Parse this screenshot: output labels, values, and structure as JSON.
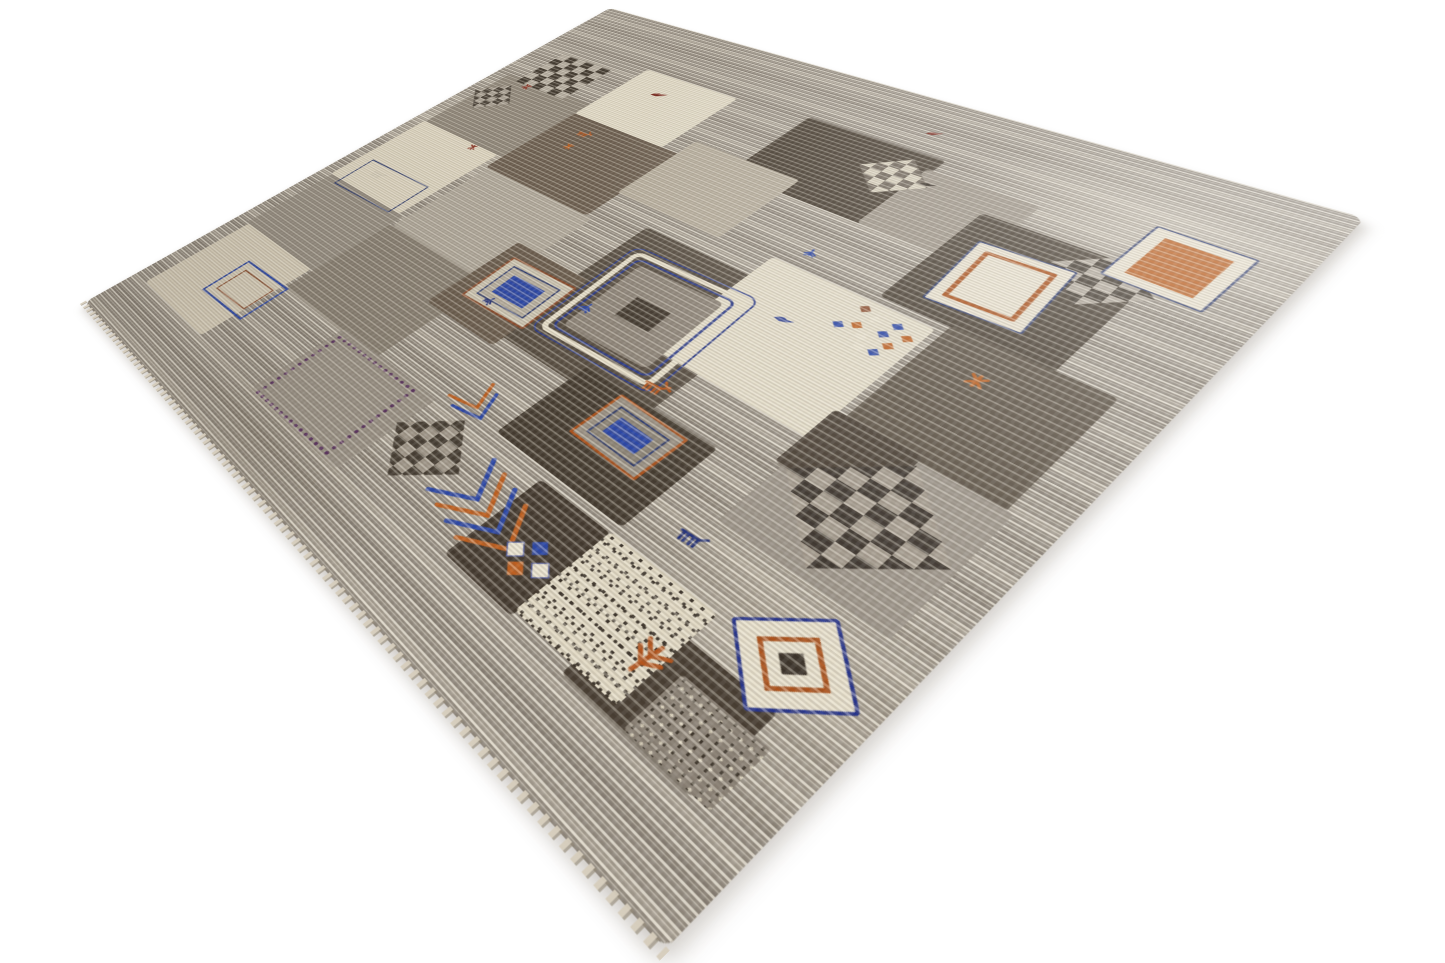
{
  "scene": {
    "label": "Hand-knotted grey patchwork Gabbeh wool rug with checkerboard, framed-rectangle and animal motifs, photographed at an angle on a white background"
  },
  "palette": {
    "background": "#ffffff",
    "field_gray": "#a49d93",
    "cream": "#e6dfcb",
    "taupe": "#8f8679",
    "brown": "#6b5d4e",
    "dark_brown": "#453b2f",
    "rust_orange": "#bd5f1f",
    "royal_blue": "#2b47a8",
    "navy": "#2c3a6e",
    "maroon": "#7c2a20"
  },
  "glyphs": {
    "bird": {
      "vb": "0 0 20 14",
      "d": "M1 11 Q6 3 12 6 L19 4 L14 9 L8 12 Z",
      "fill": true
    },
    "animal": {
      "vb": "0 0 22 16",
      "d": "M3 6 H16 M16 6 L20 3 M5 6 V13 M8 6 V13 M12 6 V13 M15 6 V13"
    },
    "deer": {
      "vb": "0 0 24 18",
      "d": "M4 8 H17 M17 8 L21 4 M19 5 L23 7 M18 4 L16 1 M6 8 V15 M9 8 V15 M13 8 V15 M16 8 V15"
    },
    "plant": {
      "vb": "0 0 20 20",
      "d": "M10 2 V18 M10 8 L4 3 M10 8 L16 3 M10 13 L4 8 M10 13 L16 8"
    },
    "mark": {
      "vb": "0 0 12 12",
      "d": "M2 2 L10 10 M10 2 L2 10 M6 1 V11"
    },
    "sprig": {
      "vb": "0 0 16 16",
      "d": "M8 3 V13 M8 7 L3 11 M8 7 L13 11 M8 10 L4 14 M8 10 L12 14"
    }
  },
  "elements": [
    {
      "t": "patch",
      "n": "patch-taupe-left",
      "x": 25,
      "y": 252,
      "w": 178,
      "h": 172,
      "c": "#8f8679"
    },
    {
      "t": "patch",
      "n": "patch-cream-left",
      "x": 22,
      "y": 424,
      "w": 168,
      "h": 178,
      "c": "#e2dac5"
    },
    {
      "t": "patch",
      "n": "patch-gray-left",
      "x": 25,
      "y": 602,
      "w": 175,
      "h": 150,
      "c": "#978f83"
    },
    {
      "t": "patch",
      "n": "patch-cream-left-low",
      "x": 30,
      "y": 752,
      "w": 165,
      "h": 168,
      "c": "#dcd3be"
    },
    {
      "t": "patch",
      "n": "patch-cream-top",
      "x": 200,
      "y": 130,
      "w": 162,
      "h": 152,
      "c": "#e5deca"
    },
    {
      "t": "patch",
      "n": "patch-brown-mid",
      "x": 200,
      "y": 282,
      "w": 192,
      "h": 172,
      "c": "#6b5d4e"
    },
    {
      "t": "patch",
      "n": "patch-lightgray-mid",
      "x": 205,
      "y": 454,
      "w": 198,
      "h": 170,
      "c": "#b2aa9d"
    },
    {
      "t": "patch",
      "n": "patch-taupe-mid",
      "x": 200,
      "y": 624,
      "w": 198,
      "h": 170,
      "c": "#898073"
    },
    {
      "t": "patch",
      "n": "patch-gray-bottom",
      "x": 328,
      "y": 790,
      "w": 175,
      "h": 132,
      "c": "#9a9286"
    },
    {
      "t": "patch",
      "n": "patch-darkbrown-top",
      "x": 468,
      "y": 120,
      "w": 184,
      "h": 160,
      "c": "#453b2f"
    },
    {
      "t": "patch",
      "n": "patch-warmgray-top",
      "x": 388,
      "y": 246,
      "w": 158,
      "h": 148,
      "c": "#b7ae9d"
    },
    {
      "t": "patch",
      "n": "patch-medallion-host",
      "x": 468,
      "y": 428,
      "w": 208,
      "h": 248,
      "c": "#564c40"
    },
    {
      "t": "patch",
      "n": "patch-brown-g",
      "x": 366,
      "y": 545,
      "w": 118,
      "h": 148,
      "c": "#6a5c4d"
    },
    {
      "t": "patch",
      "n": "patch-dark-o",
      "x": 585,
      "y": 648,
      "w": 168,
      "h": 128,
      "c": "#433a2f"
    },
    {
      "t": "patch",
      "n": "patch-cream-center",
      "x": 614,
      "y": 386,
      "w": 188,
      "h": 198,
      "c": "#e6dfcb"
    },
    {
      "t": "patch",
      "n": "patch-gray-top-mid",
      "x": 645,
      "y": 146,
      "w": 128,
      "h": 134,
      "c": "#9d9487"
    },
    {
      "t": "patch",
      "n": "patch-dark-right",
      "x": 735,
      "y": 190,
      "w": 172,
      "h": 184,
      "c": "#483e32"
    },
    {
      "t": "patch",
      "n": "patch-brown-right",
      "x": 810,
      "y": 372,
      "w": 150,
      "h": 176,
      "c": "#5a5043"
    },
    {
      "t": "patch",
      "n": "patch-gray-right-low",
      "x": 806,
      "y": 545,
      "w": 160,
      "h": 168,
      "c": "#9c9489"
    },
    {
      "t": "patch",
      "n": "patch-dark-corner",
      "x": 798,
      "y": 538,
      "w": 86,
      "h": 88,
      "c": "#473d32"
    },
    {
      "t": "patch",
      "n": "patch-dark-dots",
      "x": 662,
      "y": 788,
      "w": 90,
      "h": 120,
      "c": "#42382e"
    },
    {
      "t": "patch",
      "n": "patch-dark-bottom-right",
      "x": 818,
      "y": 820,
      "w": 130,
      "h": 94,
      "c": "#473d32"
    },
    {
      "t": "checker",
      "n": "checker-top-left",
      "x": 52,
      "y": 160,
      "w": 102,
      "h": 102,
      "cell": 17,
      "c1": "#40382e",
      "c2": "#b7afa2"
    },
    {
      "t": "checker",
      "n": "checker-top-left-2",
      "x": 16,
      "y": 276,
      "w": 80,
      "h": 80,
      "cell": 13,
      "c1": "#4a4238",
      "c2": "#aaa295",
      "clip": 1
    },
    {
      "t": "checker",
      "n": "checker-top-mid",
      "x": 580,
      "y": 136,
      "w": 86,
      "h": 86,
      "cell": 14,
      "c1": "#6e6458",
      "c2": "#d9d1bd",
      "clip": 1
    },
    {
      "t": "checker",
      "n": "checker-right",
      "x": 826,
      "y": 180,
      "w": 96,
      "h": 96,
      "cell": 16,
      "c1": "#40382e",
      "c2": "#b3ab9e",
      "clip": 1
    },
    {
      "t": "checker",
      "n": "checker-large-bottom",
      "x": 810,
      "y": 550,
      "w": 152,
      "h": 152,
      "cell": 19,
      "c1": "#39312a",
      "c2": "#a59c8f",
      "clip": 1
    },
    {
      "t": "checker",
      "n": "checker-bottom-left",
      "x": 498,
      "y": 788,
      "w": 102,
      "h": 102,
      "cell": 15,
      "c1": "#453d33",
      "c2": "#a39a8d",
      "clip": 1
    },
    {
      "t": "frame",
      "n": "medallion",
      "x": 488,
      "y": 458,
      "w": 168,
      "h": 184,
      "rot": -3,
      "layers": [
        {
          "bc": "#2a3a8a",
          "bw": 2,
          "r": 14
        },
        {
          "i": 7,
          "bc": "#e9e1cc",
          "bw": 7,
          "r": 12
        },
        {
          "i": 17,
          "bc": "#2a3a8a",
          "bw": 3,
          "r": 10
        },
        {
          "i": 27,
          "bg": "#8d8478",
          "r": 7
        },
        {
          "w": 46,
          "h": 38,
          "bg": "#3f362c"
        }
      ]
    },
    {
      "t": "frame",
      "n": "framed-rect-cream",
      "x": 762,
      "y": 232,
      "w": 96,
      "h": 116,
      "rot": -4,
      "layers": [
        {
          "bg": "#ebe4d1",
          "bc": "#2c3a6e",
          "bw": 2,
          "r": 3
        },
        {
          "i": 13,
          "bc": "#ad531d",
          "bw": 5,
          "bg": "#ebe4d1",
          "r": 2
        }
      ]
    },
    {
      "t": "frame",
      "n": "framed-rect-orange",
      "x": 870,
      "y": 116,
      "w": 90,
      "h": 104,
      "rot": 2,
      "layers": [
        {
          "bg": "#ebe4d1",
          "bc": "#2c3a6e",
          "bw": 2,
          "r": 3
        },
        {
          "i": 15,
          "bg": "#bd5f1f"
        }
      ]
    },
    {
      "t": "frame",
      "n": "framed-rect-blue",
      "x": 386,
      "y": 566,
      "w": 102,
      "h": 90,
      "rot": -3,
      "layers": [
        {
          "bg": "#cfc7b4",
          "bc": "#8a4a2a",
          "bw": 3,
          "r": 3
        },
        {
          "i": 13,
          "bc": "#2c3a6e",
          "bw": 2,
          "bg": "#b9b1a2"
        },
        {
          "i": 26,
          "bg": "#2b47a8"
        }
      ]
    },
    {
      "t": "frame",
      "n": "framed-rect-small",
      "x": 638,
      "y": 656,
      "w": 88,
      "h": 72,
      "rot": 2,
      "layers": [
        {
          "bc": "#ad531d",
          "bw": 3,
          "bg": "#9c9386",
          "r": 2
        },
        {
          "i": 12,
          "bc": "#2c3a6e",
          "bw": 2,
          "bg": "#8e8679"
        },
        {
          "i": 23,
          "bg": "#2b47a8"
        }
      ]
    },
    {
      "t": "frame",
      "n": "outlined-rect",
      "x": 46,
      "y": 538,
      "w": 128,
      "h": 74,
      "rot": -2,
      "layers": [
        {
          "bc": "#2c3a6e",
          "bw": 2
        }
      ]
    },
    {
      "t": "frame",
      "n": "amulet-diamond",
      "x": 891,
      "y": 740,
      "w": 80,
      "h": 80,
      "rot": 45,
      "layers": [
        {
          "bg": "#e9e2cf",
          "bc": "#26348c",
          "bw": 3,
          "r": 4
        },
        {
          "i": 17,
          "bc": "#ad531d",
          "bw": 4,
          "bg": "#e9e2cf"
        },
        {
          "i": 31,
          "bg": "#3b332a"
        }
      ]
    },
    {
      "t": "frame",
      "n": "comb-motif",
      "x": 110,
      "y": 796,
      "w": 98,
      "h": 76,
      "rot": -2,
      "layers": [
        {
          "bc": "#2b47a8",
          "bw": 3
        },
        {
          "i": 14,
          "bc": "#8a4a2a",
          "bw": 2
        }
      ]
    },
    {
      "t": "dborder",
      "n": "diamond-border-square",
      "x": 336,
      "y": 798,
      "w": 132,
      "h": 114,
      "c": "#5b3460",
      "bw": 5,
      "rot": -2
    },
    {
      "t": "zigzag",
      "n": "chevron-arrows",
      "x": 588,
      "y": 812,
      "w": 150,
      "h": 110,
      "rot": 15,
      "sw": 5,
      "strokes": [
        {
          "c": "#2b47a8",
          "pts": "8,6 44,42 8,78"
        },
        {
          "c": "#c06020",
          "pts": "30,6 66,42 30,78"
        },
        {
          "c": "#2b47a8",
          "pts": "52,6 88,42 52,78"
        },
        {
          "c": "#c06020",
          "pts": "74,6 110,42 74,78"
        }
      ]
    },
    {
      "t": "zigzag",
      "n": "chevron-small",
      "x": 508,
      "y": 742,
      "w": 80,
      "h": 64,
      "rot": 28,
      "sw": 4,
      "strokes": [
        {
          "c": "#c06020",
          "pts": "6,4 34,28 6,52"
        },
        {
          "c": "#2b47a8",
          "pts": "22,4 50,28 22,52"
        }
      ]
    },
    {
      "t": "dots4",
      "n": "four-dot-motif",
      "x": 696,
      "y": 836,
      "s": 14,
      "items": [
        {
          "dx": 0,
          "dy": 15,
          "c": "#ece5d2",
          "o": 1
        },
        {
          "dx": 16,
          "dy": 0,
          "c": "#2b47a8"
        },
        {
          "dx": 16,
          "dy": 30,
          "c": "#c06020"
        },
        {
          "dx": 32,
          "dy": 15,
          "c": "#ece5d2",
          "o": 1
        }
      ]
    },
    {
      "t": "confetti",
      "n": "confetti-cluster",
      "x": 726,
      "y": 390,
      "s": 9,
      "items": [
        [
          0,
          42,
          "#2b47a8"
        ],
        [
          14,
          32,
          "#c06020"
        ],
        [
          27,
          44,
          "#ece5d2"
        ],
        [
          40,
          28,
          "#2b47a8"
        ],
        [
          53,
          40,
          "#c06020"
        ],
        [
          22,
          14,
          "#ece5d2"
        ],
        [
          44,
          10,
          "#2b47a8"
        ],
        [
          60,
          20,
          "#c06020"
        ],
        [
          6,
          6,
          "#8a4a2a"
        ],
        [
          34,
          58,
          "#ece5d2"
        ],
        [
          48,
          56,
          "#2b47a8"
        ]
      ]
    },
    {
      "t": "speckle",
      "n": "speckled-patch",
      "x": 750,
      "y": 786,
      "w": 116,
      "h": 116,
      "bg": "#e3dbc6",
      "dot": "#3b332a"
    },
    {
      "t": "noise",
      "n": "salt-pepper-patch",
      "x": 882,
      "y": 846,
      "w": 80,
      "h": 66
    },
    {
      "t": "glyph",
      "g": "bird",
      "n": "bird-red",
      "x": 252,
      "y": 168,
      "s": 26,
      "c": "#7c2a20",
      "rot": -8
    },
    {
      "t": "glyph",
      "g": "mark",
      "n": "mark-red",
      "x": 72,
      "y": 258,
      "s": 15,
      "c": "#8a3324",
      "rot": 10
    },
    {
      "t": "glyph",
      "g": "sprig",
      "n": "sprig-blue",
      "x": 508,
      "y": 570,
      "s": 20,
      "c": "#2b47a8",
      "rot": 0
    },
    {
      "t": "glyph",
      "g": "sprig",
      "n": "sprig-blue-2",
      "x": 632,
      "y": 346,
      "s": 18,
      "c": "#2b47a8",
      "rot": -10
    },
    {
      "t": "glyph",
      "g": "mark",
      "n": "mark-orange",
      "x": 856,
      "y": 416,
      "s": 20,
      "c": "#bd5f1f",
      "rot": 0
    },
    {
      "t": "glyph",
      "g": "deer",
      "n": "deer-orange",
      "x": 640,
      "y": 612,
      "s": 34,
      "c": "#b5551d",
      "rot": -6
    },
    {
      "t": "glyph",
      "g": "deer",
      "n": "deer-orange-2",
      "x": 238,
      "y": 306,
      "s": 26,
      "c": "#b5551d",
      "rot": 0
    },
    {
      "t": "glyph",
      "g": "animal",
      "n": "horse-navy",
      "x": 788,
      "y": 732,
      "s": 30,
      "c": "#27357c",
      "rot": -5
    },
    {
      "t": "glyph",
      "g": "bird",
      "n": "bird-blue",
      "x": 676,
      "y": 456,
      "s": 22,
      "c": "#2b3f97",
      "rot": 5
    },
    {
      "t": "glyph",
      "g": "bird",
      "n": "bird-maroon-top",
      "x": 600,
      "y": 66,
      "s": 20,
      "c": "#7c2a20",
      "rot": -12
    },
    {
      "t": "glyph",
      "g": "plant",
      "n": "plant-orange",
      "x": 834,
      "y": 836,
      "s": 40,
      "c": "#b5551d",
      "rot": 8
    },
    {
      "t": "glyph",
      "g": "mark",
      "n": "mark-red-2",
      "x": 138,
      "y": 424,
      "s": 14,
      "c": "#8a3324",
      "rot": -15
    },
    {
      "t": "glyph",
      "g": "animal",
      "n": "pony-light",
      "x": 70,
      "y": 550,
      "s": 30,
      "c": "#d8d0bd",
      "rot": 0
    },
    {
      "t": "glyph",
      "g": "sprig",
      "n": "sprig-navy",
      "x": 414,
      "y": 634,
      "s": 18,
      "c": "#27357c",
      "rot": 12
    },
    {
      "t": "glyph",
      "g": "mark",
      "n": "mark-orange-2",
      "x": 250,
      "y": 344,
      "s": 14,
      "c": "#bd5f1f",
      "rot": 0
    },
    {
      "t": "glyph",
      "g": "bird",
      "n": "bird-dark",
      "x": 654,
      "y": 166,
      "s": 18,
      "c": "#332b22",
      "rot": 0
    }
  ]
}
